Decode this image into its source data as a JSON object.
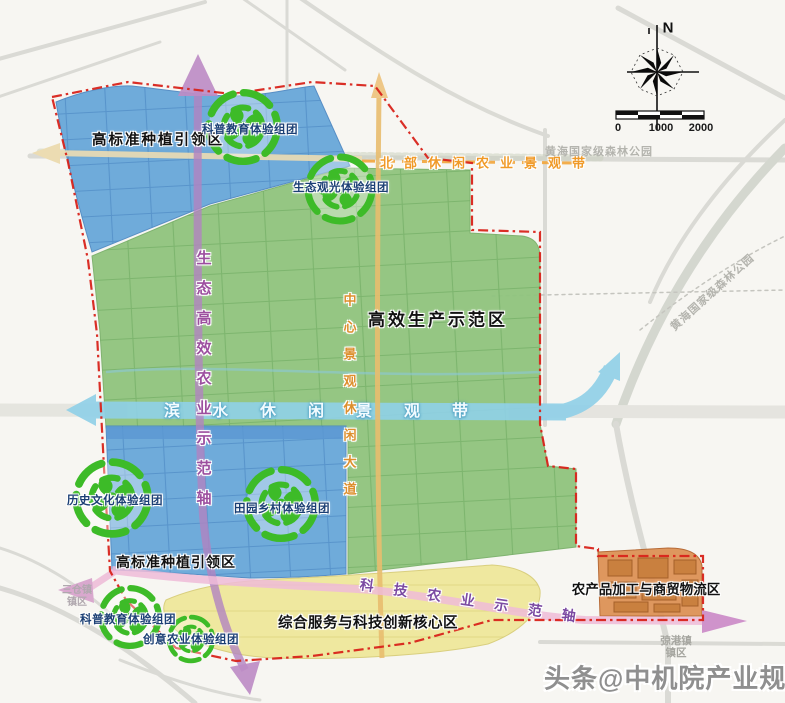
{
  "compass": {
    "north": "N"
  },
  "scale_bar": {
    "ticks": [
      "0",
      "1000",
      "2000"
    ]
  },
  "zone_labels": [
    "高标准种植引领区",
    "高效生产示范区",
    "高标准种植引领区",
    "综合服务与科技创新核心区",
    "农产品加工与商贸物流区"
  ],
  "cluster_labels": [
    "科普教育体验组团",
    "生态观光体验组团",
    "历史文化体验组团",
    "田园乡村体验组团",
    "科普教育体验组团",
    "创意农业体验组团"
  ],
  "corridors": {
    "north_belt": "北部休闲农业景观带",
    "waterfront_belt": "滨水休闲景观带",
    "eco_axis": "生态高效农业示范轴",
    "central_avenue": "中心景观休闲大道",
    "tech_axis": "科技农业示范轴"
  },
  "places": {
    "forest_park_top": "黄海国家级森林公园",
    "forest_park_right": "黄海国家级森林公园",
    "jianggang_line1": "弶港镇",
    "jianggang_line2": "镇区",
    "sancang_line1": "三仓镇",
    "sancang_line2": "镇区"
  },
  "watermark": "头条@中机院产业规划网",
  "colors": {
    "zone_green": "#90c47e",
    "zone_blue": "#64a5d8",
    "zone_yellow": "#efe89b",
    "zone_orange": "#dd9257",
    "waterfront_teal": "#8fd0e8",
    "boundary_red": "#d8231a",
    "axis_purple": "#b183c0",
    "road_orange": "#e8bc6e",
    "belt_pink": "#eebbd8",
    "cluster_icon_green": "#3dbb28"
  }
}
